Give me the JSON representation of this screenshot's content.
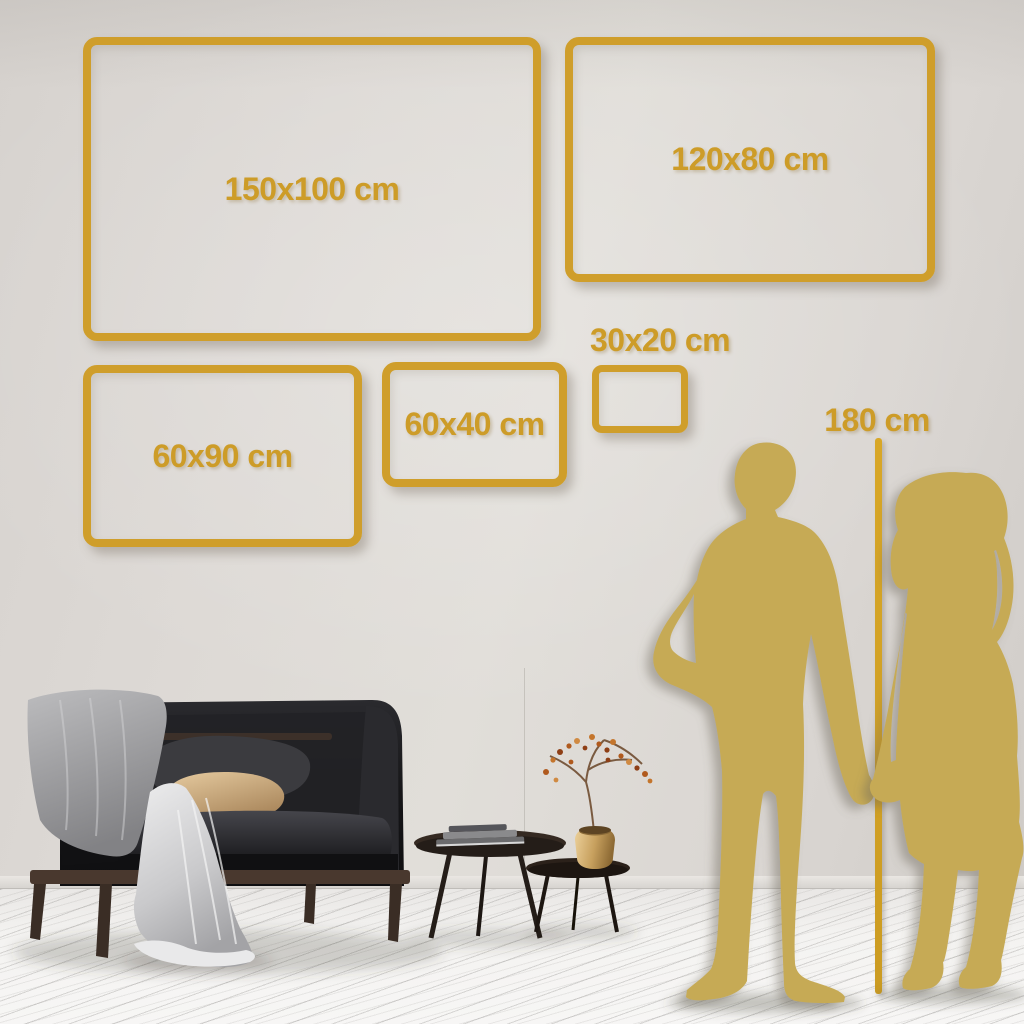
{
  "size_guide": {
    "frames": [
      {
        "id": "150x100",
        "label": "150x100 cm"
      },
      {
        "id": "120x80",
        "label": "120x80 cm"
      },
      {
        "id": "60x90",
        "label": "60x90 cm"
      },
      {
        "id": "60x40",
        "label": "60x40 cm"
      },
      {
        "id": "30x20",
        "label": "30x20 cm"
      }
    ],
    "height_reference": {
      "label": "180 cm"
    }
  },
  "scene": {
    "icons": [
      "couple-silhouette-icon",
      "man-silhouette-icon",
      "woman-silhouette-icon",
      "sofa-icon",
      "throw-blanket-icon",
      "coffee-table-large-icon",
      "coffee-table-small-icon",
      "books-icon",
      "vase-icon",
      "branch-icon"
    ],
    "colors": {
      "frame_gold": "#cf9e2b",
      "label_gold": "#cd9c28",
      "ruler_gold": "#d3a125",
      "silhouette_gold": "#c6aa54",
      "wall": "#dcd8d4",
      "floor": "#f2f1ef",
      "sofa_black": "#1a1a1c",
      "wood_brown": "#49382e",
      "pillow_tan": "#d3b58a",
      "pillow_gray": "#3c3c40",
      "blanket_gray": "#a9a9ab",
      "throw_light": "#dcdcde",
      "vase_brass": "#c9a05c",
      "berries_rust": "#b05a1e"
    }
  }
}
